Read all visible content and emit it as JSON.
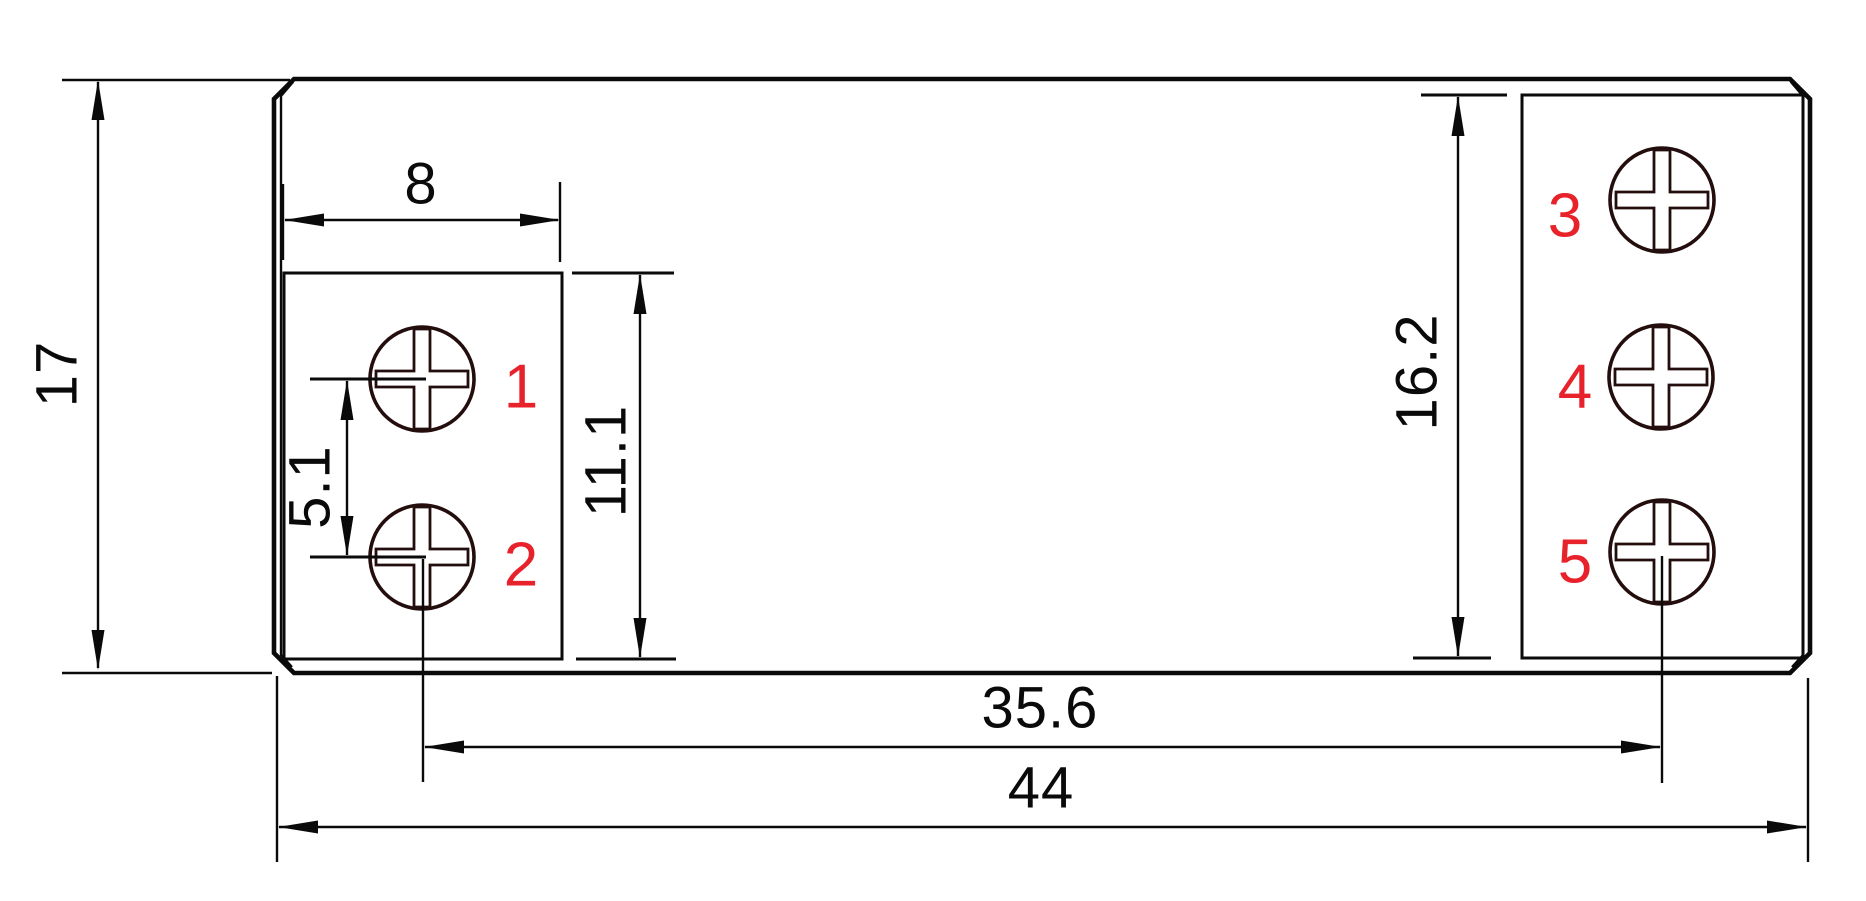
{
  "drawing": {
    "dimensions": {
      "overall_height": "17",
      "left_recess_width": "8",
      "screw_pitch": "5.1",
      "left_recess_height": "11.1",
      "right_recess_height": "16.2",
      "screw_column_span": "35.6",
      "overall_width": "44"
    },
    "terminals": [
      {
        "label": "1"
      },
      {
        "label": "2"
      },
      {
        "label": "3"
      },
      {
        "label": "4"
      },
      {
        "label": "5"
      }
    ],
    "colors": {
      "background": "#ffffff",
      "line": "#0a0a0a",
      "screw_outline": "#230d0d",
      "terminal_number": "#e8222b"
    }
  }
}
